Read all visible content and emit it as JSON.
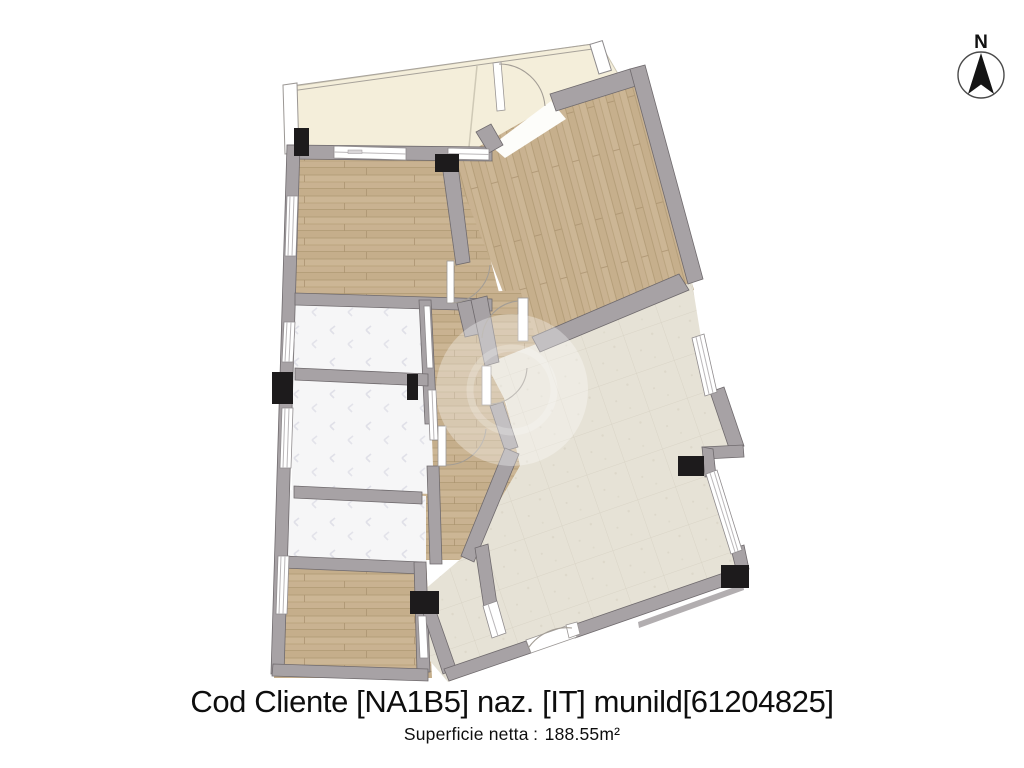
{
  "title": {
    "text": "Cod Cliente [NA1B5] naz. [IT] munild[61204825]"
  },
  "subtitle": {
    "label": "Superficie netta",
    "separator": ":",
    "value": "188.55m²"
  },
  "compass": {
    "label": "N"
  },
  "plan": {
    "type": "apartment-floorplan",
    "colors": {
      "wood_floor": "#ccb695",
      "tile_floor": "#e6e2d6",
      "balcony_floor": "#f4eeda",
      "bath_floor": "#f6f6f7",
      "wall": "#a7a2a5",
      "column": "#1d1b1c",
      "background": "#ffffff"
    },
    "rooms": [
      {
        "name": "balcony-top",
        "floor": "balcony"
      },
      {
        "name": "bedroom-top-left",
        "floor": "wood"
      },
      {
        "name": "bedroom-top-right",
        "floor": "wood"
      },
      {
        "name": "hallway-center",
        "floor": "wood"
      },
      {
        "name": "bathroom-left-a",
        "floor": "bath"
      },
      {
        "name": "bathroom-left-b",
        "floor": "bath"
      },
      {
        "name": "bathroom-left-c",
        "floor": "bath"
      },
      {
        "name": "room-bottom-left",
        "floor": "wood"
      },
      {
        "name": "living-room-right",
        "floor": "tile"
      }
    ]
  }
}
